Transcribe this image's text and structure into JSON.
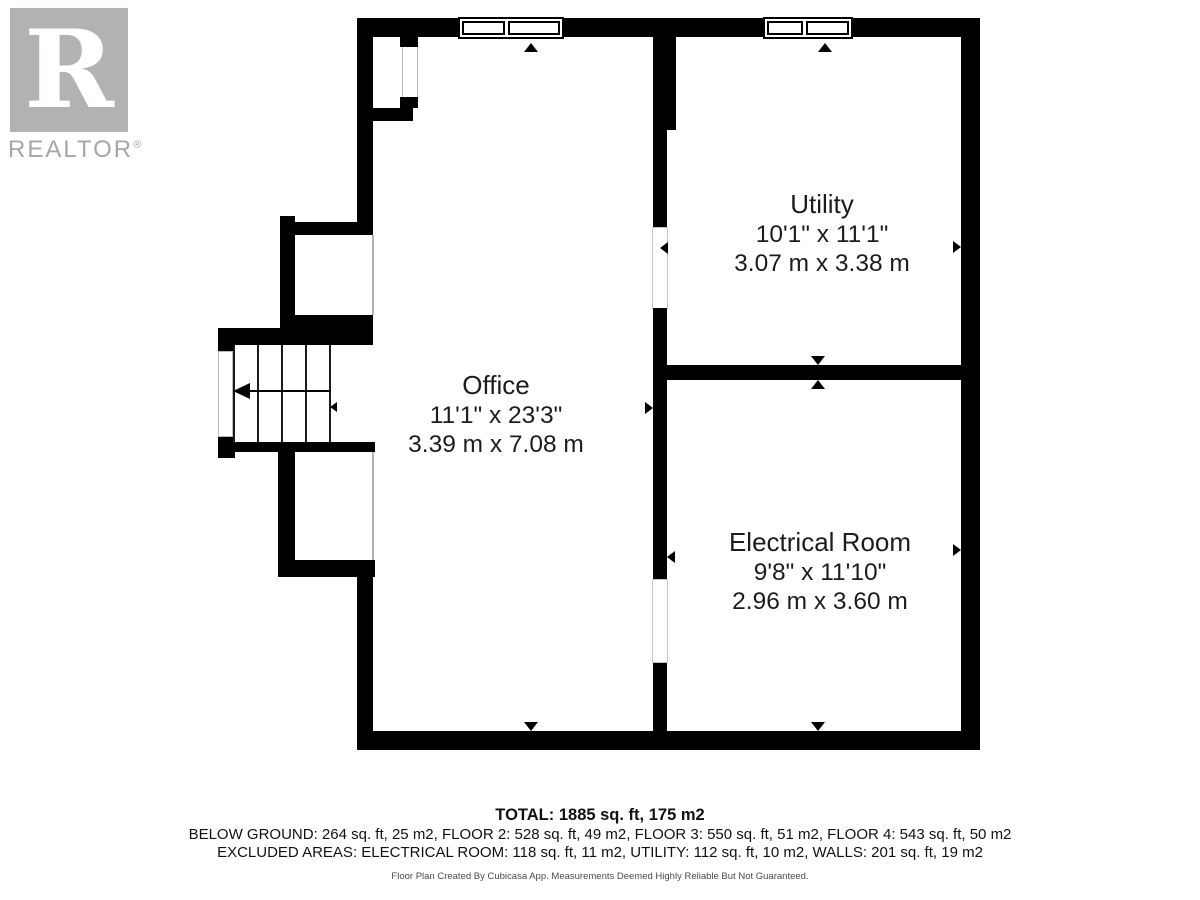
{
  "logo": {
    "letter": "R",
    "word": "REALTOR",
    "reg_mark": "®"
  },
  "rooms": {
    "utility": {
      "name": "Utility",
      "imperial": "10'1\" x 11'1\"",
      "metric": "3.07 m x 3.38 m"
    },
    "office": {
      "name": "Office",
      "imperial": "11'1\" x 23'3\"",
      "metric": "3.39 m x 7.08 m"
    },
    "electrical": {
      "name": "Electrical Room",
      "imperial": "9'8\" x 11'10\"",
      "metric": "2.96 m x 3.60 m"
    }
  },
  "summary": {
    "total": "TOTAL: 1885 sq. ft, 175 m2",
    "floors": "BELOW GROUND: 264 sq. ft, 25 m2, FLOOR 2: 528 sq. ft, 49 m2, FLOOR 3: 550 sq. ft, 51 m2, FLOOR 4: 543 sq. ft, 50 m2",
    "excluded": "EXCLUDED AREAS: ELECTRICAL ROOM: 118 sq. ft, 11 m2, UTILITY: 112 sq. ft, 10 m2, WALLS: 201 sq. ft, 19 m2",
    "disclaimer": "Floor Plan Created By Cubicasa App. Measurements Deemed Highly Reliable But Not Guaranteed."
  }
}
